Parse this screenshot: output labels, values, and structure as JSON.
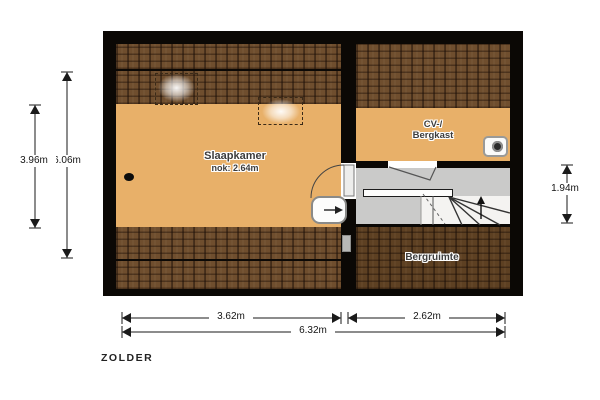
{
  "floorplan": {
    "title": "ZOLDER",
    "rooms": {
      "bedroom": {
        "name": "Slaapkamer",
        "ridge_height": "nok: 2.64m"
      },
      "cv_closet": {
        "name_line1": "CV-/",
        "name_line2": "Bergkast"
      },
      "storage": {
        "name": "Bergruimte"
      }
    },
    "dimensions": {
      "left_inner": "3.96m",
      "left_outer": "6.06m",
      "right": "1.94m",
      "bottom_left": "3.62m",
      "bottom_right": "2.62m",
      "bottom_total": "6.32m"
    },
    "icons": {
      "boiler": "cv-boiler-icon",
      "stairs_direction": "up-arrow-icon",
      "hatch_arrow": "right-arrow-icon"
    },
    "colors": {
      "floor": "#e8b069",
      "roof_hatch": "#6f4e2e",
      "roof_hatch_dark": "#5d4022",
      "wall": "#0b0805",
      "landing": "#cacac9"
    }
  }
}
